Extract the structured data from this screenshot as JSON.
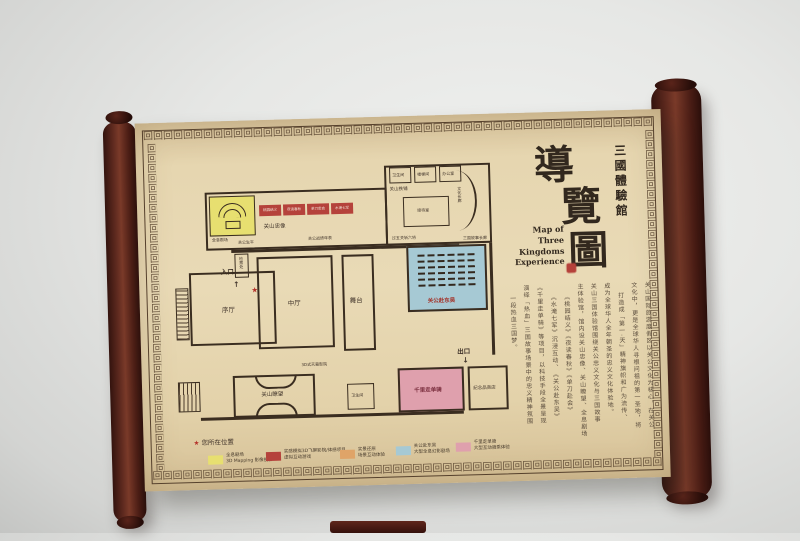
{
  "title": {
    "venue": "三國體驗館",
    "map_char_1": "導",
    "map_char_2": "覽",
    "map_char_3": "圖",
    "english_line1": "Map of",
    "english_line2": "Three Kingdoms",
    "english_line3": "Experience"
  },
  "map": {
    "entrance": "入口",
    "exit": "出口",
    "entrance_arrow": "↑",
    "exit_arrow": "↓",
    "star": "★",
    "rooms": {
      "holo_theater": "全息剧场",
      "guanshan_statue": "关山忠像",
      "guan_life": "关公生平",
      "guan_timeline": "关公战绩年表",
      "story_corridor": "三国故事长廊",
      "ticket_check": "检票处",
      "prologue_hall": "序厅",
      "central_hall": "中厅",
      "stage": "舞台",
      "dongwu_theater": "关公赴东吴",
      "blacksmith": "关山铁铺",
      "reception": "接待室",
      "corridor": "文化长廊",
      "five_passes": "过五关斩六将",
      "restroom_top1": "卫生间",
      "stairs_room": "楼梯间",
      "office": "办公室",
      "dome_cinema": "3D式天幕影院",
      "lookout": "关山瞭望",
      "restroom_mid": "卫生间",
      "ride_experience": "千里走单骑",
      "souvenir_shop": "纪念品商店"
    },
    "exhibits": [
      "桃园结义",
      "夜读春秋",
      "单刀赴会",
      "水淹七军"
    ]
  },
  "legend": {
    "you_are_here": "您所在位置",
    "items": [
      {
        "color": "#e7df70",
        "line1": "全息剧场",
        "line2": "3D Mapping 影像投影"
      },
      {
        "color": "#b5423b",
        "line1": "实感模拟3D飞屏影院/体感项目",
        "line2": "虚拟互动游戏"
      },
      {
        "color": "#dfa468",
        "line1": "实景还原",
        "line2": "场景互动体验"
      },
      {
        "color": "#a6c9d4",
        "line1": "关公赴东吴",
        "line2": "大型全息幻影剧场"
      },
      {
        "color": "#dfa0ad",
        "line1": "千里走单骑",
        "line2": "大型互动骑乘体验"
      }
    ]
  },
  "description": {
    "columns": [
      "关山国际旅游度假区以关公文化为核心，在关公",
      "文化中，更是全球华人寻根问祖的第一圣地，将",
      "打造成「第一·天」精神旗帜和广为流传、",
      "成为全球华人全年朝圣的忠义文化体验地。",
      "关山三国体验馆围绕关公忠义文化与三国故事",
      "主体验馆，馆内设关山忠像、关山瞭望、全息剧场",
      "《桃园结义》《夜读春秋》《单刀赴会》",
      "《水淹七军》沉浸互动、《关公赴东吴》",
      "《千里走单骑》等项目，以科技手段全景呈现",
      "演绎「热血」三国故事场景中的忠义精神氛围",
      "一段热血三国梦。"
    ]
  },
  "colors": {
    "paper": "#e6d6b0",
    "roller": "#5f2a1f",
    "wall_line": "#3a2d20",
    "accent_red": "#b5423b",
    "theater_blue": "#a6c9d4",
    "ride_pink": "#dfa0ad",
    "holo_yellow": "#e7df70"
  }
}
